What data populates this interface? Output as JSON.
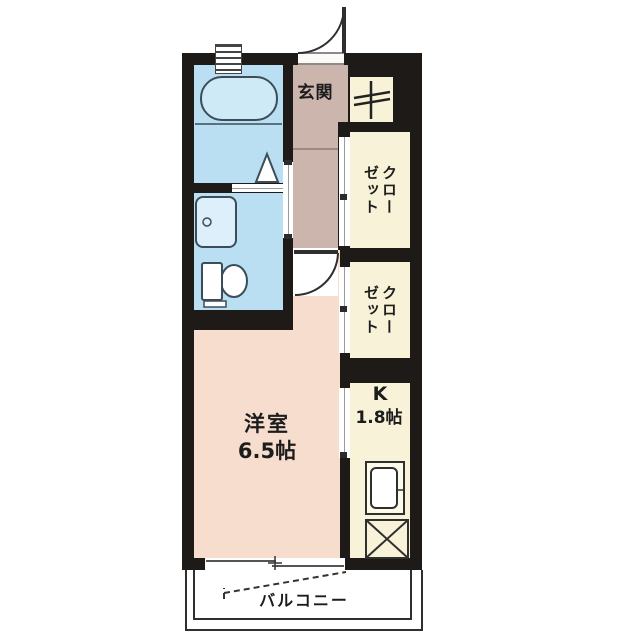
{
  "plan_type": "apartment-floorplan",
  "rooms": {
    "entrance": {
      "label": "玄関"
    },
    "closet_top": {
      "label": "クローゼット"
    },
    "closet_bottom": {
      "label": "クローゼット"
    },
    "kitchen": {
      "name": "K",
      "size": "1.8帖"
    },
    "western_room": {
      "name": "洋室",
      "size": "6.5帖"
    },
    "balcony": {
      "label": "バルコニー"
    }
  },
  "fixtures": [
    "bathtub",
    "washbasin",
    "toilet",
    "bathroom-window",
    "bath-door-mark",
    "washroom-sliding-door",
    "entrance-door-swing",
    "room-door-swing",
    "closet-doors",
    "kitchen-sink",
    "range-space",
    "utility-meter",
    "balcony-sliding-window",
    "eave-dashed-line"
  ],
  "colors": {
    "wall": "#1d1a17",
    "wet_area": "#badff2",
    "fixture_light": "#cfeaf7",
    "hall": "#ccb5ad",
    "room": "#f6ddcd",
    "storage": "#f8f3d8",
    "outline": "#3b4d59",
    "line": "#2f2f2f",
    "background": "#ffffff"
  }
}
